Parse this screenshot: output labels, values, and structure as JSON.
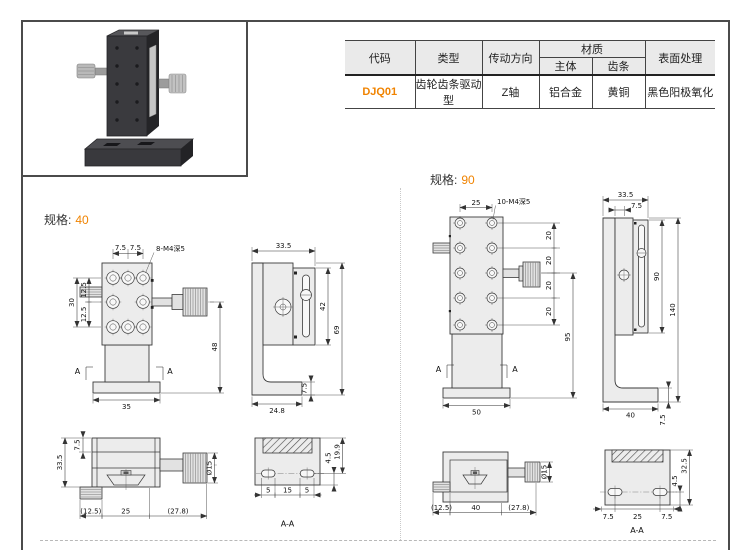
{
  "colors": {
    "accent": "#F08300",
    "header_bg": "#EAEAEA",
    "line": "#3A3A3A",
    "fill": "#ECECEC"
  },
  "table": {
    "col_code": "代码",
    "col_type": "类型",
    "col_direction": "传动方向",
    "col_material": "材质",
    "col_body": "主体",
    "col_rack": "齿条",
    "col_surface": "表面处理",
    "row": {
      "code": "DJQ01",
      "type": "齿轮齿条驱动型",
      "direction": "Z轴",
      "body": "铝合金",
      "rack": "黄铜",
      "surface": "黑色阳极氧化"
    }
  },
  "spec40": {
    "label": "规格:",
    "value": "40",
    "front": {
      "pitch1": "7.5",
      "pitch2": "7.5",
      "thread": "8-M4深5",
      "row1": "12.5",
      "row2": "12.5",
      "rows": "30",
      "height": "48",
      "base": "35",
      "sec": "A"
    },
    "side": {
      "width": "33.5",
      "travel": "42",
      "height": "69",
      "foot": "7.5",
      "base": "24.8"
    },
    "top": {
      "edge": "7.5",
      "width": "33.5",
      "dia": "Ø15",
      "left": "(12.5)",
      "mid": "25",
      "right": "(27.8)"
    },
    "section": {
      "s1": "4.5",
      "s2": "19.9",
      "b1": "5",
      "b2": "15",
      "b3": "5",
      "label": "A-A"
    }
  },
  "spec90": {
    "label": "规格:",
    "value": "90",
    "front": {
      "pitch": "25",
      "thread": "10-M4深5",
      "row": "20",
      "height": "95",
      "base": "50",
      "sec": "A"
    },
    "side": {
      "width": "33.5",
      "edge": "7.5",
      "travel": "90",
      "height": "140",
      "base": "40",
      "foot": "7.5"
    },
    "top": {
      "dia": "Ø15",
      "left": "(12.5)",
      "mid": "40",
      "right": "(27.8)"
    },
    "section": {
      "s1": "4.5",
      "s2": "32.5",
      "b1": "7.5",
      "b2": "25",
      "b3": "7.5",
      "label": "A-A"
    }
  }
}
